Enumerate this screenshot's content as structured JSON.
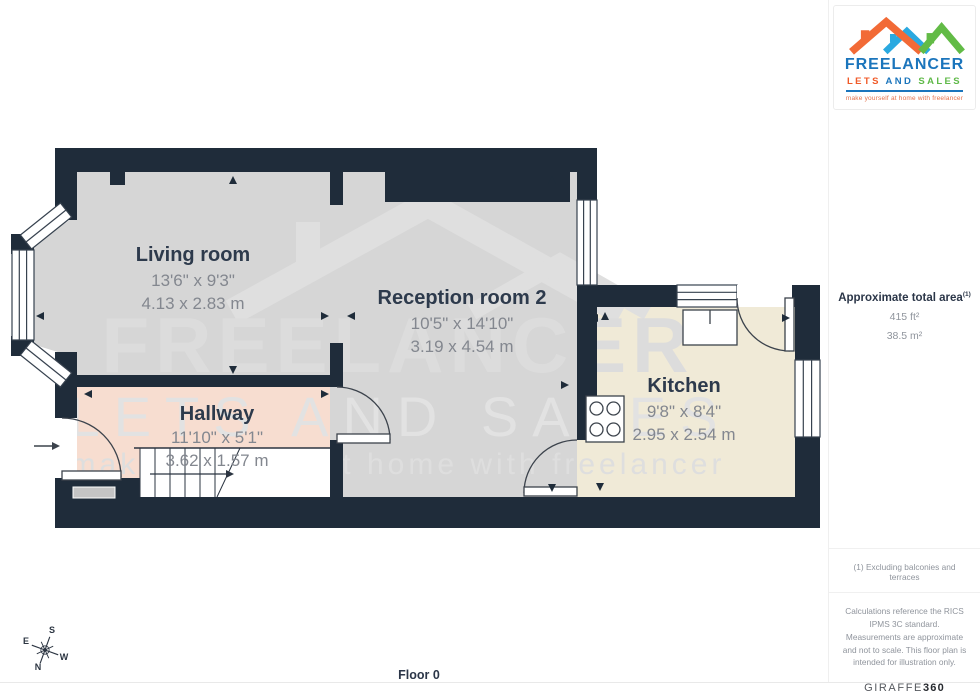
{
  "page": {
    "floor_label": "Floor 0"
  },
  "colors": {
    "wall": "#1f2c3a",
    "room_gray": "#d6d6d6",
    "hallway_pink": "#f7ddd0",
    "kitchen_cream": "#f0ead7",
    "label_dark": "#2d3a4c",
    "label_gray": "#83878f",
    "brand_blue": "#1b75bc",
    "brand_orange": "#f05a28",
    "brand_green": "#5fb948"
  },
  "watermark": {
    "line1": "FREELANCER",
    "line2": "LETS AND SALES",
    "line3": "make yourself at home with freelancer"
  },
  "rooms": [
    {
      "name": "Living room",
      "dims_ft": "13'6\" x 9'3\"",
      "dims_m": "4.13 x 2.83 m"
    },
    {
      "name": "Reception room 2",
      "dims_ft": "10'5\" x 14'10\"",
      "dims_m": "3.19 x 4.54 m"
    },
    {
      "name": "Hallway",
      "dims_ft": "11'10\" x 5'1\"",
      "dims_m": "3.62 x 1.57 m"
    },
    {
      "name": "Kitchen",
      "dims_ft": "9'8\" x 8'4\"",
      "dims_m": "2.95 x 2.54 m"
    }
  ],
  "compass": {
    "n": "N",
    "s": "S",
    "e": "E",
    "w": "W"
  },
  "branding": {
    "name": "FREELANCER",
    "sub": [
      "LETS",
      "AND",
      "SALES"
    ],
    "tagline": "make yourself at home with freelancer"
  },
  "sidebar": {
    "area_title": "Approximate total area",
    "area_superscript": "(1)",
    "area_ft": "415 ft²",
    "area_m": "38.5 m²",
    "footnote": "(1) Excluding balconies and terraces",
    "disclaimer": "Calculations reference the RICS IPMS 3C standard. Measurements are approximate and not to scale. This floor plan is intended for illustration only.",
    "provider_name": "GIRAFFE",
    "provider_suffix": "360"
  }
}
